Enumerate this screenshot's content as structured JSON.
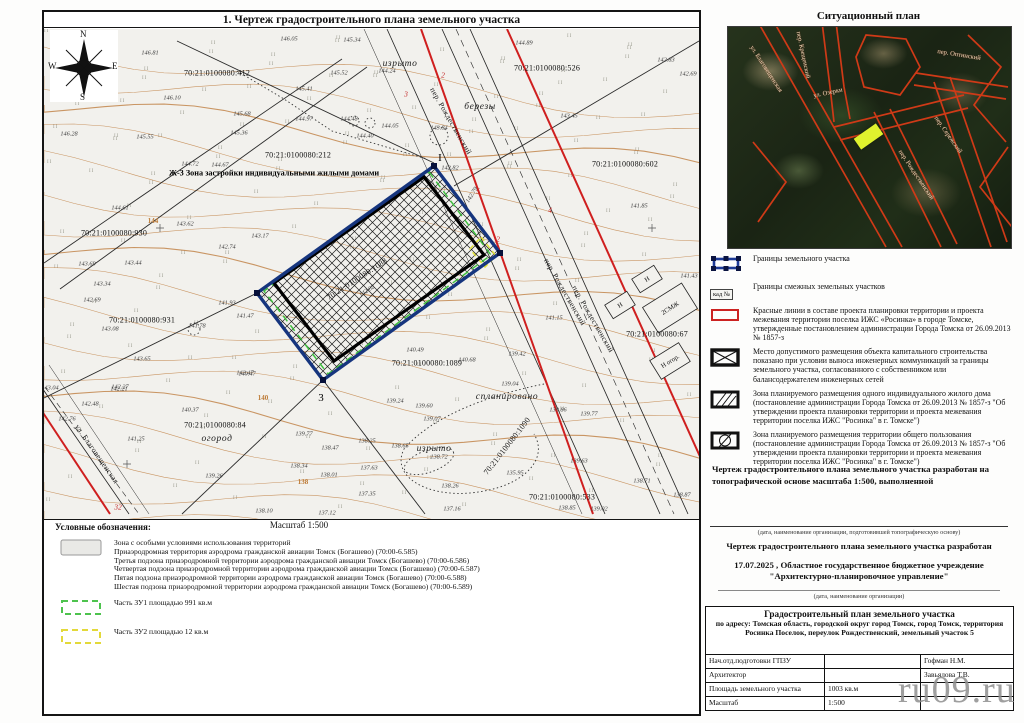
{
  "drawing": {
    "title": "1. Чертеж градостроительного плана земельного участка",
    "scale": "Масштаб 1:500"
  },
  "compass": {
    "n": "N",
    "w": "W",
    "e": "E",
    "s": "S"
  },
  "situational": {
    "title": "Ситуационный план",
    "plot_color": "#dff22e",
    "streets": [
      {
        "t": "ул. Благовещенская",
        "x": 38,
        "y": 42,
        "r": 57
      },
      {
        "t": "пер. Крещенский",
        "x": 75,
        "y": 28,
        "r": 78
      },
      {
        "t": "ул. Озерки",
        "x": 100,
        "y": 66,
        "r": -12
      },
      {
        "t": "пер. Оптинский",
        "x": 231,
        "y": 28,
        "r": 9
      },
      {
        "t": "пер. Рождественский",
        "x": 188,
        "y": 148,
        "r": 56
      },
      {
        "t": "пер. Сережский",
        "x": 220,
        "y": 108,
        "r": 55
      }
    ]
  },
  "map": {
    "zone_label": "Ж-3 Зона застройки индивидуальными жилыми домами",
    "cadastral": [
      {
        "t": "70:21:0100080:412",
        "x": 173,
        "y": 44
      },
      {
        "t": "70:21:0100080:526",
        "x": 503,
        "y": 39
      },
      {
        "t": "70:21:0100080:212",
        "x": 254,
        "y": 126
      },
      {
        "t": "70:21:0100080:602",
        "x": 581,
        "y": 135
      },
      {
        "t": "70:21:0100080:930",
        "x": 70,
        "y": 204
      },
      {
        "t": "70:21:0100080:931",
        "x": 98,
        "y": 291
      },
      {
        "t": "70:21:0100080:1088",
        "x": 313,
        "y": 250,
        "r": -33
      },
      {
        "t": "70:21:0100080:84",
        "x": 171,
        "y": 396
      },
      {
        "t": "70:21:0100080:1089",
        "x": 383,
        "y": 334
      },
      {
        "t": "70:21:0100080:533",
        "x": 518,
        "y": 468
      },
      {
        "t": "70:21:0100080:1090",
        "x": 463,
        "y": 417,
        "r": -52
      },
      {
        "t": "70:21:0100080:67",
        "x": 613,
        "y": 305
      }
    ],
    "places": [
      {
        "t": "изрыто",
        "x": 356,
        "y": 35
      },
      {
        "t": "березы",
        "x": 436,
        "y": 78
      },
      {
        "t": "огород",
        "x": 173,
        "y": 410
      },
      {
        "t": "спланировано",
        "x": 463,
        "y": 368
      },
      {
        "t": "изрыто",
        "x": 390,
        "y": 420
      }
    ],
    "streets": [
      {
        "t": "пер. Рождественский",
        "x": 407,
        "y": 92,
        "r": 60
      },
      {
        "t": "пер. Рождественский",
        "x": 521,
        "y": 263,
        "r": 60
      },
      {
        "t": "пер. Рождественский",
        "x": 549,
        "y": 290,
        "r": 60
      },
      {
        "t": "ул. Благовещенская",
        "x": 53,
        "y": 425,
        "r": 55
      }
    ],
    "red_numbers": [
      {
        "t": "2",
        "x": 399,
        "y": 46
      },
      {
        "t": "3",
        "x": 362,
        "y": 65
      },
      {
        "t": "5",
        "x": 434,
        "y": 162
      },
      {
        "t": "4",
        "x": 506,
        "y": 181
      },
      {
        "t": "32",
        "x": 74,
        "y": 478
      },
      {
        "t": "2",
        "x": 454,
        "y": 210
      }
    ],
    "contour_labels": [
      {
        "t": "144",
        "x": 109,
        "y": 192
      },
      {
        "t": "140",
        "x": 219,
        "y": 369
      },
      {
        "t": "138",
        "x": 259,
        "y": 453
      }
    ],
    "markers": [
      {
        "t": "I",
        "x": 396,
        "y": 129
      },
      {
        "t": "3",
        "x": 277,
        "y": 369
      }
    ],
    "buildings": [
      {
        "t": "Н",
        "x": 603,
        "y": 250,
        "w": 26,
        "h": 16,
        "r": -32
      },
      {
        "t": "Н",
        "x": 576,
        "y": 276,
        "w": 26,
        "h": 16,
        "r": -32
      },
      {
        "t": "2СМЖ",
        "x": 626,
        "y": 279,
        "w": 46,
        "h": 30,
        "r": -32
      },
      {
        "t": "Н огор.",
        "x": 626,
        "y": 332,
        "w": 34,
        "h": 22,
        "r": -32
      }
    ],
    "elevations": [
      {
        "v": "146.81",
        "x": 106,
        "y": 24
      },
      {
        "v": "145.83",
        "x": 64,
        "y": 34
      },
      {
        "v": "146.05",
        "x": 245,
        "y": 10
      },
      {
        "v": "145.34",
        "x": 308,
        "y": 11
      },
      {
        "v": "145.52",
        "x": 295,
        "y": 44
      },
      {
        "v": "145.41",
        "x": 260,
        "y": 60
      },
      {
        "v": "144.24",
        "x": 343,
        "y": 42
      },
      {
        "v": "144.97",
        "x": 260,
        "y": 90
      },
      {
        "v": "144.48",
        "x": 305,
        "y": 90
      },
      {
        "v": "144.05",
        "x": 346,
        "y": 97
      },
      {
        "v": "144.40",
        "x": 321,
        "y": 107
      },
      {
        "v": "143.84",
        "x": 395,
        "y": 99
      },
      {
        "v": "145.68",
        "x": 198,
        "y": 85
      },
      {
        "v": "145.36",
        "x": 195,
        "y": 104
      },
      {
        "v": "146.10",
        "x": 128,
        "y": 69
      },
      {
        "v": "146.28",
        "x": 25,
        "y": 105
      },
      {
        "v": "145.55",
        "x": 101,
        "y": 108
      },
      {
        "v": "144.72",
        "x": 146,
        "y": 135
      },
      {
        "v": "144.67",
        "x": 176,
        "y": 136
      },
      {
        "v": "144.89",
        "x": 480,
        "y": 14
      },
      {
        "v": "142.83",
        "x": 622,
        "y": 31
      },
      {
        "v": "142.69",
        "x": 644,
        "y": 45
      },
      {
        "v": "143.45",
        "x": 525,
        "y": 87
      },
      {
        "v": "141.85",
        "x": 595,
        "y": 177
      },
      {
        "v": "144.61",
        "x": 76,
        "y": 179
      },
      {
        "v": "143.62",
        "x": 141,
        "y": 195
      },
      {
        "v": "143.17",
        "x": 216,
        "y": 207
      },
      {
        "v": "142.74",
        "x": 183,
        "y": 218
      },
      {
        "v": "143.69",
        "x": 43,
        "y": 235
      },
      {
        "v": "143.44",
        "x": 89,
        "y": 234
      },
      {
        "v": "143.34",
        "x": 58,
        "y": 255
      },
      {
        "v": "142.69",
        "x": 48,
        "y": 271
      },
      {
        "v": "143.08",
        "x": 66,
        "y": 300
      },
      {
        "v": "141.93",
        "x": 183,
        "y": 274
      },
      {
        "v": "141.47",
        "x": 201,
        "y": 287
      },
      {
        "v": "141.78",
        "x": 153,
        "y": 297
      },
      {
        "v": "143.65",
        "x": 98,
        "y": 330
      },
      {
        "v": "142.21",
        "x": 75,
        "y": 360
      },
      {
        "v": "143.04",
        "x": 6,
        "y": 359
      },
      {
        "v": "142.47",
        "x": 201,
        "y": 344
      },
      {
        "v": "142.82",
        "x": 406,
        "y": 139
      },
      {
        "v": "142.79",
        "x": 428,
        "y": 166,
        "r": -58
      },
      {
        "v": "142.02",
        "x": 323,
        "y": 262,
        "r": -33
      },
      {
        "v": "140.47",
        "x": 203,
        "y": 345
      },
      {
        "v": "140.37",
        "x": 146,
        "y": 381
      },
      {
        "v": "141.25",
        "x": 92,
        "y": 410
      },
      {
        "v": "139.26",
        "x": 170,
        "y": 447
      },
      {
        "v": "139.77",
        "x": 260,
        "y": 405
      },
      {
        "v": "138.47",
        "x": 286,
        "y": 419
      },
      {
        "v": "138.34",
        "x": 255,
        "y": 437
      },
      {
        "v": "138.01",
        "x": 285,
        "y": 446
      },
      {
        "v": "139.24",
        "x": 351,
        "y": 372
      },
      {
        "v": "139.60",
        "x": 380,
        "y": 377
      },
      {
        "v": "139.07",
        "x": 388,
        "y": 390
      },
      {
        "v": "138.65",
        "x": 356,
        "y": 417
      },
      {
        "v": "138.72",
        "x": 395,
        "y": 428
      },
      {
        "v": "140.49",
        "x": 371,
        "y": 321
      },
      {
        "v": "140.68",
        "x": 423,
        "y": 331
      },
      {
        "v": "139.42",
        "x": 473,
        "y": 325
      },
      {
        "v": "139.04",
        "x": 466,
        "y": 355
      },
      {
        "v": "141.43",
        "x": 645,
        "y": 247
      },
      {
        "v": "141.15",
        "x": 510,
        "y": 289
      },
      {
        "v": "139.86",
        "x": 514,
        "y": 381
      },
      {
        "v": "139.77",
        "x": 545,
        "y": 385
      },
      {
        "v": "139.63",
        "x": 535,
        "y": 432
      },
      {
        "v": "138.71",
        "x": 598,
        "y": 452
      },
      {
        "v": "138.87",
        "x": 638,
        "y": 466
      },
      {
        "v": "138.85",
        "x": 523,
        "y": 479
      },
      {
        "v": "139.02",
        "x": 555,
        "y": 480
      },
      {
        "v": "138.10",
        "x": 220,
        "y": 482
      },
      {
        "v": "137.12",
        "x": 283,
        "y": 484
      },
      {
        "v": "137.35",
        "x": 323,
        "y": 465
      },
      {
        "v": "137.16",
        "x": 408,
        "y": 480
      },
      {
        "v": "142.27",
        "x": 76,
        "y": 358
      },
      {
        "v": "142.48",
        "x": 46,
        "y": 375
      },
      {
        "v": "142.76",
        "x": 23,
        "y": 390
      },
      {
        "v": "138.25",
        "x": 323,
        "y": 412
      },
      {
        "v": "137.63",
        "x": 325,
        "y": 439
      },
      {
        "v": "135.95",
        "x": 471,
        "y": 444
      },
      {
        "v": "138.26",
        "x": 406,
        "y": 457
      }
    ]
  },
  "right_legend": {
    "items": [
      {
        "icon": "boundary",
        "text": "Границы земельного участка"
      },
      {
        "icon": "kad",
        "icon_label": "кад №",
        "text": "Границы смежных земельных участков"
      },
      {
        "icon": "redline",
        "text": "Красные линии в составе проекта планировки территории и проекта межевания территории поселка ИЖС «Росинка» в городе Томске, утвержденные постановлением администрации Города Томска от 26.09.2013 № 1857-з"
      },
      {
        "icon": "capital",
        "text": "Место допустимого размещения объекта капитального строительства показано при условии выноса инженерных коммуникаций за границы земельного участка, согласованного с собственником или балансодержателем инженерных сетей"
      },
      {
        "icon": "house",
        "text": "Зона планируемого размещения одного индивидуального жилого дома (постановление администрации Города Томска от 26.09.2013 № 1857-з \"Об утверждении проекта планировки территории и проекта межевания территории поселка ИЖС \"Росинка\" в г. Томске\")"
      },
      {
        "icon": "common",
        "text": "Зона планируемого размещения территории общего пользования (постановление администрации Города Томска от 26.09.2013 № 1857-з \"Об утверждении проекта планировки территории и проекта межевания территории поселка ИЖС \"Росинка\" в г. Томске\")"
      }
    ]
  },
  "notes": {
    "topo_basis": "Чертеж градостроительного плана земельного участка разработан на топографической основе масштаба 1:500, выполненной",
    "caption_topo": "(дата, наименование организации, подготовившей топографическую основу)",
    "developed": "Чертеж градостроительного плана земельного участка разработан",
    "org": "17.07.2025 , Областное государственное бюджетное учреждение \"Архитектурно-планировочное управление\"",
    "caption_org": "(дата, наименование организации)"
  },
  "left_legend": {
    "title": "Условные обозначения:",
    "items": [
      {
        "icon": "special",
        "lines": [
          "Зона с особыми условиями использования территорий",
          "Приаэродромная территория аэродрома гражданской авиации Томск (Богашево) (70:00-6.585)",
          "Третья подзона приаэродромной территории аэродрома гражданской авиации Томск (Богашево) (70:00-6.586)",
          "Четвертая подзона приаэродромной территории аэродрома гражданской авиации Томск (Богашево) (70:00-6.587)",
          "Пятая подзона приаэродромной территории аэродрома гражданской авиации Томск (Богашево) (70:00-6.588)",
          "Шестая подзона приаэродромной территории аэродрома гражданской авиации Томск (Богашево) (70:00-6.589)"
        ]
      },
      {
        "icon": "zu1",
        "text": "Часть ЗУ1 площадью 991 кв.м"
      },
      {
        "icon": "zu2",
        "text": "Часть ЗУ2 площадью 12 кв.м"
      }
    ]
  },
  "title_block": {
    "title": "Градостроительный план земельного участка",
    "address": "по адресу: Томская область, городской округ город Томск, город Томск, территория Росинка Поселок, переулок Рождественский, земельный участок 5",
    "rows": [
      [
        "Нач.отд.подготовки ГПЗУ",
        "",
        "Гофман Н.М."
      ],
      [
        "Архитектор",
        "",
        "Завьялова Т.В."
      ],
      [
        "Площадь земельного участка",
        "1003 кв.м",
        ""
      ],
      [
        "Масштаб",
        "1:500",
        ""
      ]
    ]
  },
  "watermark": "ru09.ru",
  "colors": {
    "red_line": "#cf1f1f",
    "plot_border": "#16357e",
    "zu1_dash": "#3fbf3f",
    "zu2_dash": "#e2e23a",
    "contour": "#c2854a",
    "sat_street": "#cf3a17"
  }
}
